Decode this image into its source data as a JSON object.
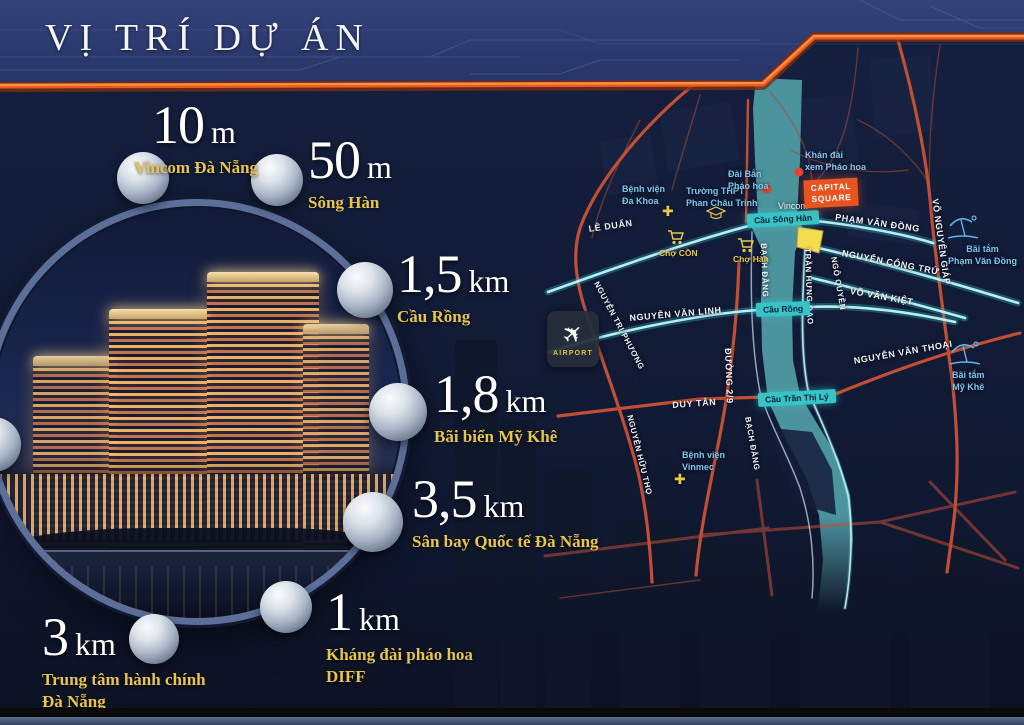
{
  "title": "VỊ TRÍ DỰ ÁN",
  "colors": {
    "background": "#0e1529",
    "header_blue": "#2d3c6a",
    "accent_orange": "#ff8a2a",
    "gold": "#e7c44c",
    "river_teal": "#4f9aa2",
    "road_red": "#c14f36",
    "road_teal": "#c8f4f6",
    "label_blue": "#7ec5ec",
    "badge_orange": "#e9531f"
  },
  "distances": [
    {
      "value": "10",
      "unit": "m",
      "place1": "Vincom Đà Nẵng",
      "place2": ""
    },
    {
      "value": "50",
      "unit": "m",
      "place1": "Sông Hàn",
      "place2": ""
    },
    {
      "value": "1,5",
      "unit": "km",
      "place1": "Cầu Rồng",
      "place2": ""
    },
    {
      "value": "1,8",
      "unit": "km",
      "place1": "Bãi biển Mỹ Khê",
      "place2": ""
    },
    {
      "value": "3,5",
      "unit": "km",
      "place1": "Sân bay Quốc tế Đà Nẵng",
      "place2": ""
    },
    {
      "value": "1",
      "unit": "km",
      "place1": "Kháng đài pháo hoa",
      "place2": "DIFF"
    },
    {
      "value": "3",
      "unit": "km",
      "place1": "Trung tâm hành chính",
      "place2": "Đà Nẵng"
    }
  ],
  "map": {
    "project_badge": {
      "line1": "CAPITAL",
      "line2": "SQUARE"
    },
    "airport_label": "AIRPORT",
    "bridges": {
      "song_han": "Cầu Sông Hàn",
      "rong": "Cầu Rồng",
      "tran_thi_ly": "Cầu Trần Thị Lý"
    },
    "streets": {
      "le_duan": "LÊ DUẨN",
      "pham_van_dong": "PHẠM VĂN ĐỒNG",
      "nguyen_cong_tru": "NGUYỄN CÔNG TRỨ",
      "vo_van_kiet": "VÕ VĂN KIỆT",
      "nguyen_van_linh": "NGUYỄN VĂN LINH",
      "duy_tan": "DUY TÂN",
      "duong_2_9": "ĐƯỜNG 2/9",
      "bach_dang": "BẠCH ĐẰNG",
      "tran_hung_dao": "TRẦN HƯNG ĐẠO",
      "ngo_quyen": "NGÔ QUYỀN",
      "vo_nguyen_giap": "VÕ NGUYÊN GIÁP",
      "nguyen_tri_phuong": "NGUYỄN TRI PHƯƠNG",
      "nguyen_huu_tho": "NGUYỄN HỮU THỌ",
      "nguyen_van_thoai": "NGUYỄN VĂN THOẠI"
    },
    "landmarks": {
      "vincom": "Vincom",
      "da_khoa1": "Bệnh viện",
      "da_khoa2": "Đa Khoa",
      "thpt1": "Trường THPT",
      "thpt2": "Phan Châu Trinh",
      "dai_ban1": "Đài Bắn",
      "dai_ban2": "Pháo hoa",
      "khan_dai1": "Khán đài",
      "khan_dai2": "xem Pháo hoa",
      "cho_con": "Chợ CỒN",
      "cho_han": "Chợ Hàn",
      "vinmec1": "Bệnh viện",
      "vinmec2": "Vinmec",
      "beach_pvd1": "Bãi tắm",
      "beach_pvd2": "Phạm Văn Đồng",
      "beach_mk1": "Bãi tắm",
      "beach_mk2": "Mỹ Khê"
    }
  }
}
